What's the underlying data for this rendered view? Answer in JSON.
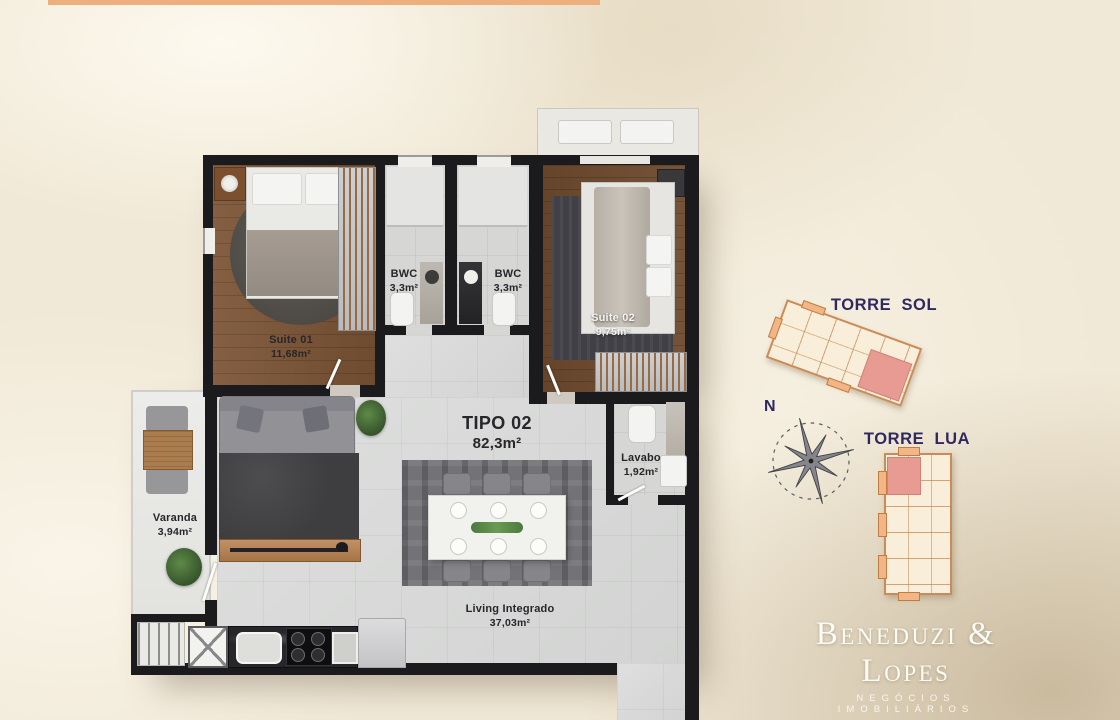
{
  "plan": {
    "unit_type": "TIPO 02",
    "unit_area": "82,3m²",
    "rooms": {
      "suite01": {
        "label": "Suite 01",
        "area": "11,68m²"
      },
      "bwc1": {
        "label": "BWC",
        "area": "3,3m²"
      },
      "bwc2": {
        "label": "BWC",
        "area": "3,3m²"
      },
      "suite02": {
        "label": "Suite 02",
        "area": "9,75m²"
      },
      "lavabo": {
        "label": "Lavabo",
        "area": "1,92m²"
      },
      "varanda": {
        "label": "Varanda",
        "area": "3,94m²"
      },
      "living": {
        "label": "Living Integrado",
        "area": "37,03m²"
      }
    }
  },
  "site": {
    "torre_sol": "TORRE SOL",
    "torre_lua": "TORRE LUA",
    "compass_north": "N"
  },
  "brand": {
    "name": "Beneduzi & Lopes",
    "tagline": "NEGÓCIOS IMOBILIÁRIOS",
    "creci": "CRECI 2774-J"
  },
  "colors": {
    "accent_bar": "#edaf7d",
    "navy": "#2f2960",
    "wall": "#1b1b1d",
    "highlight_unit": "#e89b93",
    "background": "#f1e9d7"
  }
}
